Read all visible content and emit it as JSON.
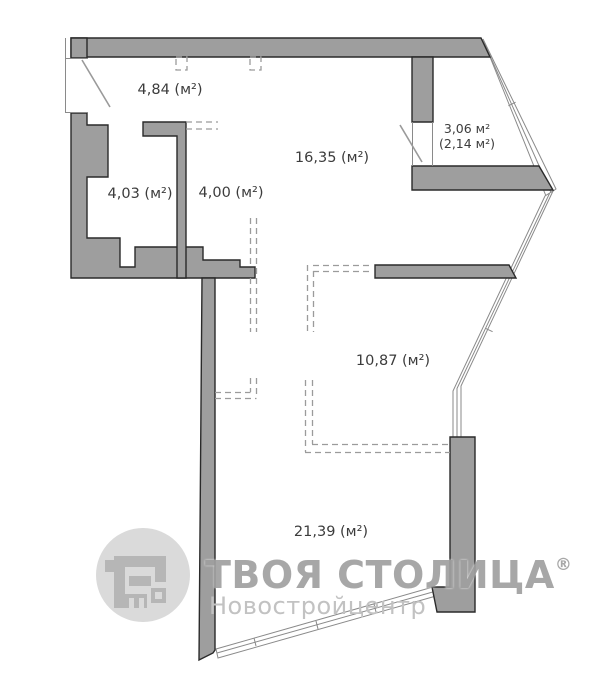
{
  "plan_type": "apartment floor plan",
  "rooms": {
    "hallway": "4,84 (м²)",
    "living_main": "16,35 (м²)",
    "bathroom": "4,03 (м²)",
    "corridor": "4,00 (м²)",
    "balcony_full": "3,06 м²",
    "balcony_coef": "(2,14 м²)",
    "room_planned": "10,87 (м²)",
    "living_large": "21,39 (м²)"
  },
  "watermark": {
    "brand": "ТВОЯ СТОЛИЦА",
    "registered_mark": "®",
    "subtitle": "Новостройцентр"
  },
  "colors": {
    "wall_fill": "#9e9e9e",
    "wall_outline": "#2a2a2a",
    "dashed_partition": "#9b9b9b",
    "glazing_line": "#8a8a8a",
    "label_text": "#3c3c3c",
    "watermark_brand": "#a0a0a0",
    "watermark_subtitle": "#c2c2c2",
    "logo_circle": "#dadada",
    "logo_glyph": "#b6b6b6",
    "background": "#ffffff"
  }
}
